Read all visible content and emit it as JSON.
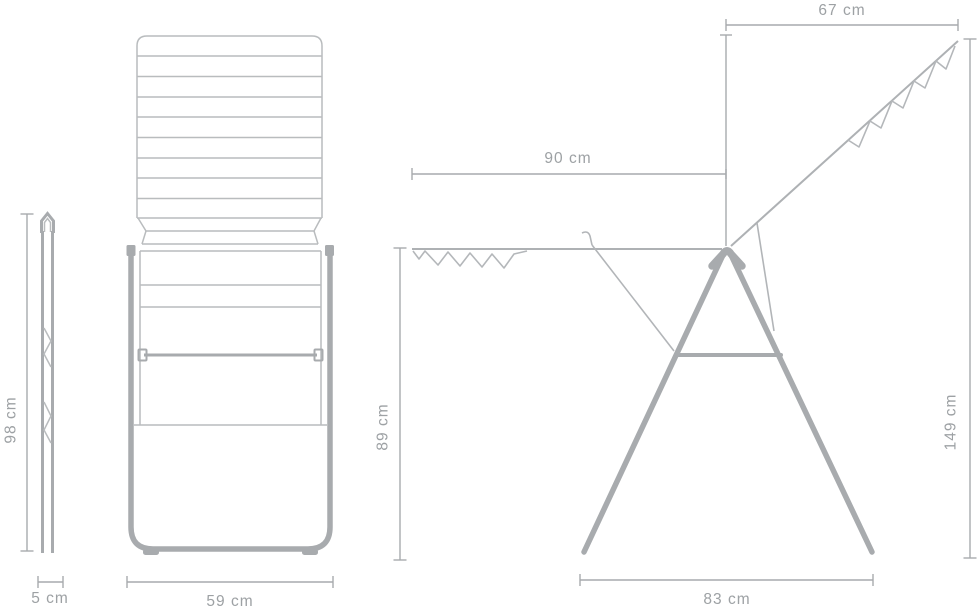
{
  "colors": {
    "background": "#ffffff",
    "line_light": "#b9bcbe",
    "line_medium": "#aeb1b4",
    "frame_gray": "#a8abae",
    "dimension_line": "#a7aaad",
    "label_text": "#9da1a4"
  },
  "views": {
    "folded_side": {
      "height_label": "98 cm",
      "depth_label": "5 cm"
    },
    "folded_front": {
      "width_label": "59 cm"
    },
    "open_side": {
      "raised_wing_label": "67 cm",
      "drying_span_label": "90 cm",
      "rail_height_label": "89 cm",
      "total_height_label": "149 cm",
      "base_width_label": "83 cm"
    }
  }
}
